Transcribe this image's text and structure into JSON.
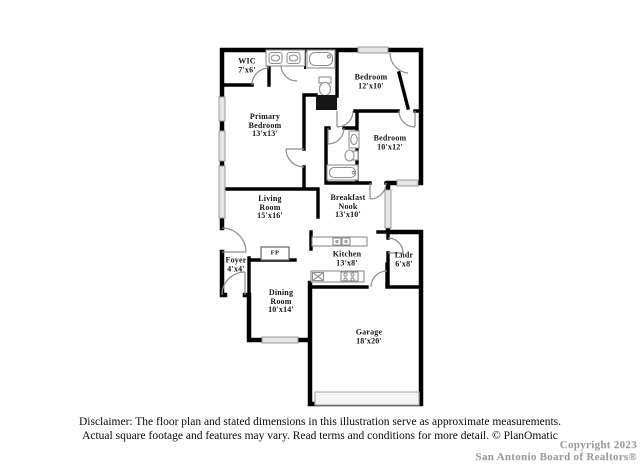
{
  "background": "#ffffff",
  "colors": {
    "wall": "#000000",
    "window_fill": "#e6e6e6",
    "window_stroke": "#9a9a9a",
    "door_arc": "#8c8c8c",
    "fixture_stroke": "#909090",
    "shower_fill": "#161616",
    "garage_door_fill": "#f4f4f4",
    "watermark_gray": "#9c9c9c"
  },
  "floorplan": {
    "rooms": [
      {
        "id": "wic",
        "lines": [
          "WIC",
          "7'x6'"
        ]
      },
      {
        "id": "primary-bedroom",
        "lines": [
          "Primary",
          "Bedroom",
          "13'x13'"
        ]
      },
      {
        "id": "bedroom-12x10",
        "lines": [
          "Bedroom",
          "12'x10'"
        ]
      },
      {
        "id": "bedroom-10x12",
        "lines": [
          "Bedroom",
          "10'x12'"
        ]
      },
      {
        "id": "living-room",
        "lines": [
          "Living",
          "Room",
          "15'x16'"
        ]
      },
      {
        "id": "breakfast-nook",
        "lines": [
          "Breakfast",
          "Nook",
          "13'x10'"
        ]
      },
      {
        "id": "foyer",
        "lines": [
          "Foyer",
          "4'x4'"
        ]
      },
      {
        "id": "kitchen",
        "lines": [
          "Kitchen",
          "13'x8'"
        ]
      },
      {
        "id": "laundry",
        "lines": [
          "Lndr",
          "6'x8'"
        ]
      },
      {
        "id": "dining-room",
        "lines": [
          "Dining",
          "Room",
          "10'x14'"
        ]
      },
      {
        "id": "garage",
        "lines": [
          "Garage",
          "18'x20'"
        ]
      },
      {
        "id": "fireplace",
        "lines": [
          "FP"
        ]
      }
    ]
  },
  "footer": {
    "disclaimer_line1": "Disclaimer: The floor plan and stated dimensions in this illustration serve as approximate measurements.",
    "disclaimer_line2": "Actual square footage and features may vary. Read terms and conditions for more detail. © PlanOmatic"
  },
  "watermark": {
    "line1": "Copyright 2023",
    "line2": "San Antonio Board of Realtors®"
  }
}
